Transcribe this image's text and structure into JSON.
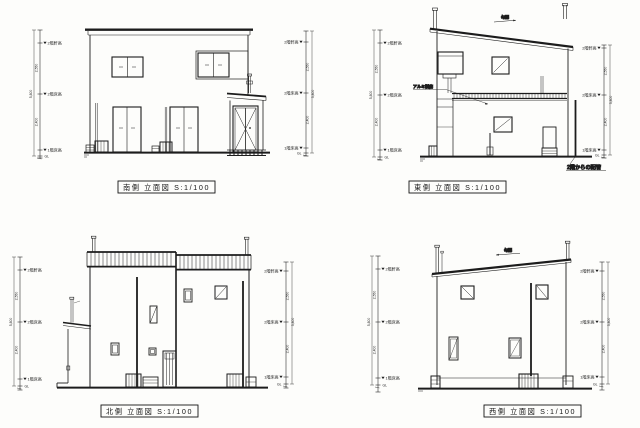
{
  "page": {
    "background": "#fdfdfb",
    "line_color": "#1c1c1c"
  },
  "panels": [
    {
      "id": "south",
      "caption": "南側 立面図 S:1/100"
    },
    {
      "id": "east",
      "caption": "東側 立面図 S:1/100"
    },
    {
      "id": "north",
      "caption": "北側 立面図 S:1/100"
    },
    {
      "id": "west",
      "caption": "西側 立面図 S:1/100"
    }
  ],
  "levels": {
    "eaves": "2階軒高",
    "fl2": "2階床高",
    "fl1": "1階床高",
    "gl": "GL"
  },
  "dims": {
    "h2": "2,550",
    "h1": "2,400",
    "total": "5,800"
  },
  "notes": {
    "pipe": "2階からの配管",
    "canopy": "アルミ製庇",
    "slope": "勾配"
  }
}
